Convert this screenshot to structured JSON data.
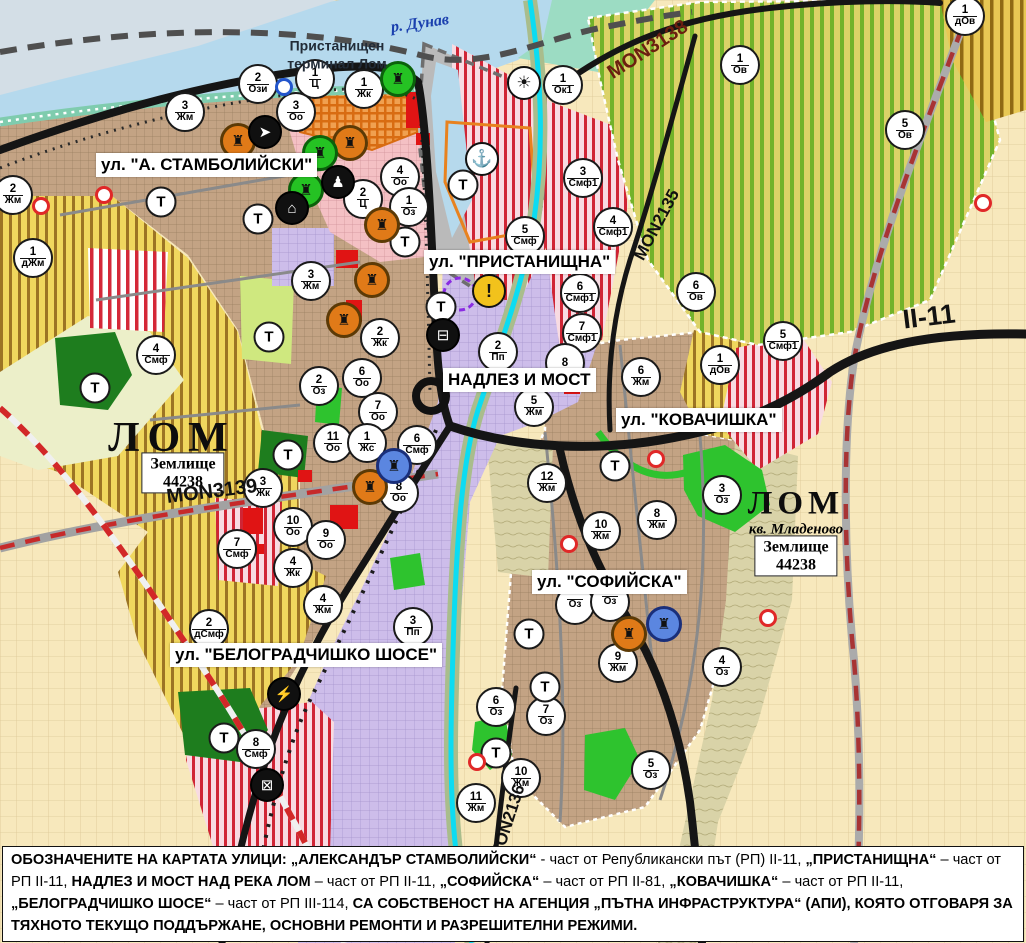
{
  "map": {
    "water": {
      "river": "р. Дунав"
    },
    "port_terminal": {
      "line1": "Пристанищен",
      "line2": "терминал Лом"
    },
    "t_label": "Т",
    "street_labels": [
      {
        "text": "ул. \"А. СТАМБОЛИЙСКИ\"",
        "x": 96,
        "y": 153
      },
      {
        "text": "ул. \"ПРИСТАНИЩНА\"",
        "x": 424,
        "y": 250
      },
      {
        "text": "НАДЛЕЗ И МОСТ",
        "x": 443,
        "y": 368
      },
      {
        "text": "ул. \"КОВАЧИШКА\"",
        "x": 616,
        "y": 408
      },
      {
        "text": "ул. \"СОФИЙСКА\"",
        "x": 532,
        "y": 570
      },
      {
        "text": "ул. \"БЕЛОГРАДЧИШКО ШОСЕ\"",
        "x": 170,
        "y": 643
      }
    ],
    "road_labels": [
      {
        "text": "MON3138",
        "x": 648,
        "y": 50,
        "angle": -33,
        "size": 20,
        "color": "#6b1f10"
      },
      {
        "text": "MON2135",
        "x": 657,
        "y": 225,
        "angle": -62,
        "size": 17,
        "color": "#111111"
      },
      {
        "text": "II-11",
        "x": 929,
        "y": 317,
        "angle": -7,
        "size": 27,
        "color": "#111111"
      },
      {
        "text": "MON3139",
        "x": 212,
        "y": 492,
        "angle": -7,
        "size": 20,
        "color": "#111111"
      },
      {
        "text": "MON2136",
        "x": 508,
        "y": 822,
        "angle": -72,
        "size": 17,
        "color": "#111111"
      }
    ],
    "cities": [
      {
        "text": "ЛОМ"
      },
      {
        "text": "ЛОМ"
      }
    ],
    "district": {
      "text": "кв. Младеново"
    },
    "land_plates": [
      {
        "line1": "Землище",
        "line2": "44238"
      },
      {
        "line1": "Землище",
        "line2": "44238"
      }
    ],
    "zone_markers": [
      {
        "n": "2",
        "c": "Ози",
        "x": 258,
        "y": 84
      },
      {
        "n": "1",
        "c": "Ц",
        "x": 315,
        "y": 79
      },
      {
        "n": "1",
        "c": "Жк",
        "x": 364,
        "y": 89
      },
      {
        "n": "3",
        "c": "Оо",
        "x": 296,
        "y": 112
      },
      {
        "n": "3",
        "c": "Жм",
        "x": 185,
        "y": 112
      },
      {
        "n": "2",
        "c": "Жм",
        "x": 13,
        "y": 195
      },
      {
        "n": "1",
        "c": "дЖм",
        "x": 33,
        "y": 258
      },
      {
        "n": "4",
        "c": "Оо",
        "x": 400,
        "y": 177
      },
      {
        "n": "1",
        "c": "Оз",
        "x": 409,
        "y": 207
      },
      {
        "n": "2",
        "c": "Ц",
        "x": 363,
        "y": 199
      },
      {
        "n": "3",
        "c": "Жм",
        "x": 311,
        "y": 281
      },
      {
        "n": "2",
        "c": "Жк",
        "x": 380,
        "y": 338
      },
      {
        "n": "6",
        "c": "Оо",
        "x": 362,
        "y": 378
      },
      {
        "n": "2",
        "c": "Оз",
        "x": 319,
        "y": 386
      },
      {
        "n": "7",
        "c": "Оо",
        "x": 378,
        "y": 412
      },
      {
        "n": "11",
        "c": "Оо",
        "x": 333,
        "y": 443
      },
      {
        "n": "1",
        "c": "Жс",
        "x": 367,
        "y": 443
      },
      {
        "n": "6",
        "c": "Смф",
        "x": 417,
        "y": 445
      },
      {
        "n": "8",
        "c": "Оо",
        "x": 399,
        "y": 493
      },
      {
        "n": "3",
        "c": "Жк",
        "x": 263,
        "y": 488
      },
      {
        "n": "4",
        "c": "Смф",
        "x": 156,
        "y": 355
      },
      {
        "n": "10",
        "c": "Оо",
        "x": 293,
        "y": 527
      },
      {
        "n": "9",
        "c": "Оо",
        "x": 326,
        "y": 540
      },
      {
        "n": "7",
        "c": "Смф",
        "x": 237,
        "y": 549
      },
      {
        "n": "4",
        "c": "Жк",
        "x": 293,
        "y": 568
      },
      {
        "n": "4",
        "c": "Жм",
        "x": 323,
        "y": 605
      },
      {
        "n": "2",
        "c": "дСмф",
        "x": 209,
        "y": 629
      },
      {
        "n": "3",
        "c": "Пп",
        "x": 413,
        "y": 627
      },
      {
        "n": "8",
        "c": "Смф",
        "x": 256,
        "y": 749
      },
      {
        "n": "1",
        "c": "Ок1",
        "x": 563,
        "y": 85
      },
      {
        "n": "3",
        "c": "Смф1",
        "x": 583,
        "y": 178
      },
      {
        "n": "4",
        "c": "Смф1",
        "x": 613,
        "y": 227
      },
      {
        "n": "5",
        "c": "Смф",
        "x": 525,
        "y": 236
      },
      {
        "n": "6",
        "c": "Смф1",
        "x": 580,
        "y": 293
      },
      {
        "n": "7",
        "c": "Смф1",
        "x": 582,
        "y": 333
      },
      {
        "n": "2",
        "c": "Пп",
        "x": 498,
        "y": 352
      },
      {
        "n": "8",
        "c": "",
        "x": 565,
        "y": 363
      },
      {
        "n": "6",
        "c": "Жм",
        "x": 641,
        "y": 377
      },
      {
        "n": "5",
        "c": "Жм",
        "x": 534,
        "y": 407
      },
      {
        "n": "12",
        "c": "Жм",
        "x": 547,
        "y": 483
      },
      {
        "n": "3",
        "c": "Оз",
        "x": 722,
        "y": 495
      },
      {
        "n": "8",
        "c": "Жм",
        "x": 657,
        "y": 520
      },
      {
        "n": "10",
        "c": "Жм",
        "x": 601,
        "y": 531
      },
      {
        "n": "",
        "c": "Оз",
        "x": 575,
        "y": 605
      },
      {
        "n": "",
        "c": "Оз",
        "x": 610,
        "y": 602
      },
      {
        "n": "9",
        "c": "Жм",
        "x": 618,
        "y": 663
      },
      {
        "n": "4",
        "c": "Оз",
        "x": 722,
        "y": 667
      },
      {
        "n": "6",
        "c": "Оз",
        "x": 496,
        "y": 707
      },
      {
        "n": "7",
        "c": "Оз",
        "x": 546,
        "y": 716
      },
      {
        "n": "10",
        "c": "Жм",
        "x": 521,
        "y": 778
      },
      {
        "n": "11",
        "c": "Жм",
        "x": 476,
        "y": 803
      },
      {
        "n": "5",
        "c": "Оз",
        "x": 651,
        "y": 770
      },
      {
        "n": "6",
        "c": "Ов",
        "x": 696,
        "y": 292
      },
      {
        "n": "1",
        "c": "дОв",
        "x": 720,
        "y": 365
      },
      {
        "n": "5",
        "c": "Смф1",
        "x": 783,
        "y": 341
      },
      {
        "n": "1",
        "c": "Ов",
        "x": 740,
        "y": 65
      },
      {
        "n": "5",
        "c": "Ов",
        "x": 905,
        "y": 130
      },
      {
        "n": "1",
        "c": "дОв",
        "x": 965,
        "y": 16
      }
    ],
    "t_markers": [
      [
        161,
        202
      ],
      [
        258,
        219
      ],
      [
        405,
        242
      ],
      [
        269,
        337
      ],
      [
        288,
        455
      ],
      [
        95,
        388
      ],
      [
        463,
        185
      ],
      [
        441,
        307
      ],
      [
        615,
        466
      ],
      [
        529,
        634
      ],
      [
        545,
        687
      ],
      [
        496,
        753
      ],
      [
        224,
        738
      ]
    ],
    "icon_markers": [
      {
        "icon": "anchor-icon",
        "x": 482,
        "y": 159,
        "style": "white"
      },
      {
        "icon": "sun-icon",
        "x": 524,
        "y": 83,
        "style": "white"
      },
      {
        "icon": "warning-icon",
        "x": 489,
        "y": 291,
        "style": "yellow"
      },
      {
        "icon": "culture-icon",
        "x": 238,
        "y": 141,
        "style": "orange"
      },
      {
        "icon": "culture-icon",
        "x": 350,
        "y": 143,
        "style": "orange"
      },
      {
        "icon": "culture-icon",
        "x": 382,
        "y": 225,
        "style": "orange"
      },
      {
        "icon": "culture-icon",
        "x": 372,
        "y": 280,
        "style": "orange"
      },
      {
        "icon": "culture-icon",
        "x": 344,
        "y": 320,
        "style": "orange"
      },
      {
        "icon": "culture-icon",
        "x": 370,
        "y": 487,
        "style": "orange"
      },
      {
        "icon": "culture-icon",
        "x": 629,
        "y": 634,
        "style": "orange"
      },
      {
        "icon": "culture-icon",
        "x": 398,
        "y": 79,
        "style": "green"
      },
      {
        "icon": "culture-icon",
        "x": 320,
        "y": 153,
        "style": "green"
      },
      {
        "icon": "culture-icon",
        "x": 306,
        "y": 190,
        "style": "green"
      },
      {
        "icon": "culture-icon",
        "x": 394,
        "y": 466,
        "style": "blue"
      },
      {
        "icon": "culture-icon",
        "x": 664,
        "y": 624,
        "style": "blue"
      },
      {
        "icon": "key-icon",
        "x": 265,
        "y": 132,
        "style": "black"
      },
      {
        "icon": "person-icon",
        "x": 338,
        "y": 182,
        "style": "black"
      },
      {
        "icon": "tunnel-icon",
        "x": 292,
        "y": 208,
        "style": "black"
      },
      {
        "icon": "bus-icon",
        "x": 443,
        "y": 335,
        "style": "black"
      },
      {
        "icon": "lightning-icon",
        "x": 284,
        "y": 694,
        "style": "black"
      },
      {
        "icon": "rail-crossing-icon",
        "x": 267,
        "y": 785,
        "style": "black"
      }
    ],
    "ring_markers": [
      {
        "x": 41,
        "y": 206,
        "color": "red"
      },
      {
        "x": 104,
        "y": 195,
        "color": "red"
      },
      {
        "x": 983,
        "y": 203,
        "color": "red"
      },
      {
        "x": 656,
        "y": 459,
        "color": "red"
      },
      {
        "x": 569,
        "y": 544,
        "color": "red"
      },
      {
        "x": 768,
        "y": 618,
        "color": "red"
      },
      {
        "x": 477,
        "y": 762,
        "color": "red"
      },
      {
        "x": 284,
        "y": 87,
        "color": "blue"
      }
    ],
    "notice": {
      "segments": [
        {
          "t": "ОБОЗНАЧЕНИТЕ НА КАРТАТА УЛИЦИ: ",
          "b": 1
        },
        {
          "t": "„АЛЕКСАНДЪР СТАМБОЛИЙСКИ“",
          "b": 1
        },
        {
          "t": " - част от Републикански път (РП) II-11, ",
          "b": 0
        },
        {
          "t": "„ПРИСТАНИЩНА“",
          "b": 1
        },
        {
          "t": " – част от РП II-11, ",
          "b": 0
        },
        {
          "t": "НАДЛЕЗ И МОСТ НАД РЕКА ЛОМ",
          "b": 1
        },
        {
          "t": " – част от РП II-11, ",
          "b": 0
        },
        {
          "t": "„СОФИЙСКА“",
          "b": 1
        },
        {
          "t": " – част от РП II-81, ",
          "b": 0
        },
        {
          "t": "„КОВАЧИШКА“",
          "b": 1
        },
        {
          "t": " – част от РП II-11, ",
          "b": 0
        },
        {
          "t": "„БЕЛОГРАДЧИШКО ШОСЕ“",
          "b": 1
        },
        {
          "t": " – част от РП III-114, ",
          "b": 0
        },
        {
          "t": "СА СОБСТВЕНОСТ НА АГЕНЦИЯ „ПЪТНА ИНФРАСТРУКТУРА“ (АПИ), КОЯТО ОТГОВАРЯ ЗА ТЯХНОТО ТЕКУЩО ПОДДЪРЖАНЕ, ОСНОВНИ РЕМОНТИ И РАЗРЕШИТЕЛНИ РЕЖИМИ.",
          "b": 1
        }
      ]
    },
    "colors": {
      "river": "#b5d9ed",
      "residential_brown": "#c3a384",
      "industrial_purple": "#cdbdea",
      "center_pink": "#f4c0c4",
      "smf_stripe_red": "#d02535",
      "vineyard_green": "#72b22a",
      "farmland_yellow": "#f0d75e",
      "park_green": "#2ec32e",
      "forest_green": "#1e7d1e",
      "road_black": "#151515",
      "boundary_red": "#d22828",
      "river_lom_cyan": "#0cdcf2",
      "marker_orange": "#e07a18",
      "marker_green": "#25c223",
      "marker_blue": "#5b86e0"
    }
  }
}
